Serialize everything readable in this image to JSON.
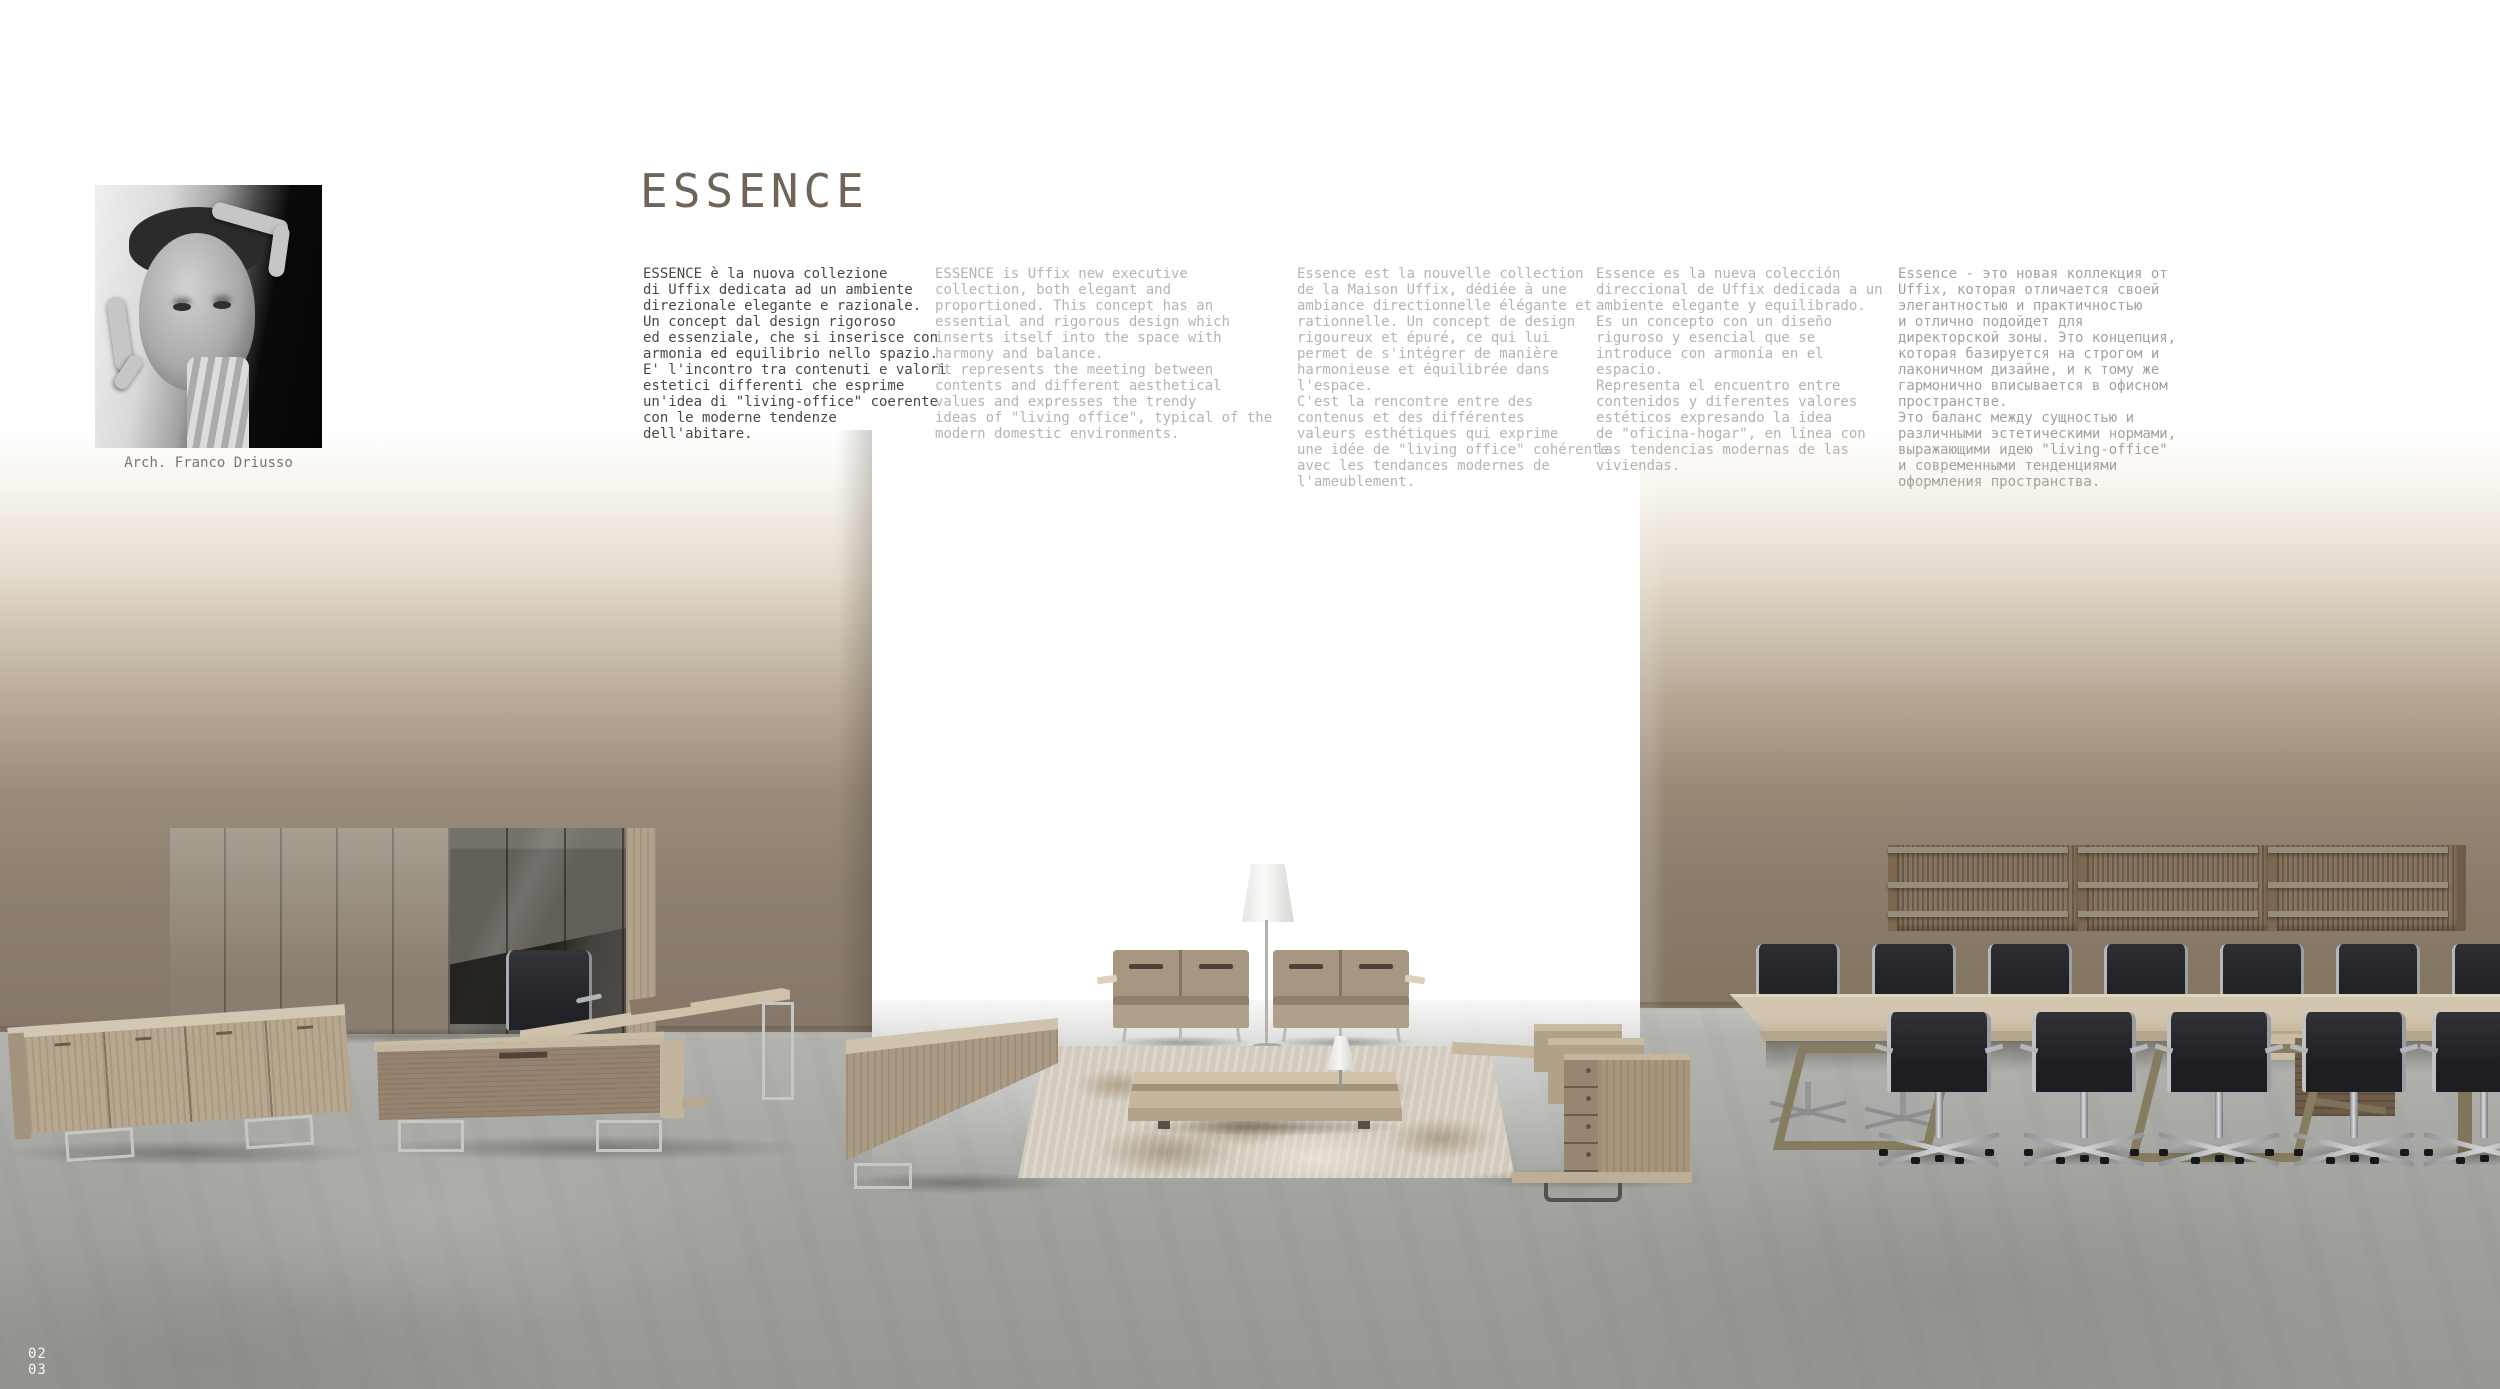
{
  "header": {
    "title": "ESSENCE"
  },
  "architect": {
    "caption": "Arch. Franco Driusso",
    "photo": "black-and-white-portrait-framing-gesture"
  },
  "columns": [
    {
      "lang": "it",
      "text": "ESSENCE è la nuova collezione\ndi Uffix dedicata ad un ambiente\ndirezionale elegante e razionale.\nUn concept dal design rigoroso\ned essenziale, che si inserisce con\narmonia ed equilibrio nello spazio.\nE' l'incontro tra contenuti e valori\nestetici differenti che esprime\nun'idea di \"living-office\" coerente\ncon le moderne tendenze\ndell'abitare."
    },
    {
      "lang": "en",
      "text": "ESSENCE is Uffix new executive\ncollection, both elegant and\nproportioned. This concept has an\nessential and rigorous design which\ninserts itself into the space with\nharmony and balance.\nIt represents the meeting between\ncontents and different aesthetical\nvalues and expresses the trendy\nideas of \"living office\", typical of the\nmodern domestic environments."
    },
    {
      "lang": "fr",
      "text": "Essence est la nouvelle collection\nde la Maison Uffix, dédiée à une\nambiance directionnelle élégante et\nrationnelle. Un concept de design\nrigoureux et épuré, ce qui lui\npermet de s'intégrer de manière\nharmonieuse et équilibrée dans\nl'espace.\nC'est la rencontre entre des\ncontenus et des différentes\nvaleurs esthétiques qui exprime\nune idée de \"living office\" cohérente\navec les tendances modernes de\nl'ameublement."
    },
    {
      "lang": "es",
      "text": "Essence es la nueva colección\ndireccional de Uffix dedicada a un\nambiente elegante y equilibrado.\nEs un concepto con un diseño\nriguroso y esencial que se\nintroduce con armonía en el\nespacio.\nRepresenta el encuentro entre\ncontenidos y diferentes valores\nestéticos expresando la idea\nde \"oficina-hogar\", en línea con\nlas tendencias modernas de las\nviviendas."
    },
    {
      "lang": "ru",
      "text": "Essence - это новая коллекция от\nUffix, которая отличается своей\nэлегантностью и практичностью\nи отлично подойдет для\nдиректорской зоны. Это концепция,\nкоторая базируется на строгом и\nлаконичном дизайне, и к тому же\nгармонично вписывается в офисном\nпространстве.\nЭто баланс между сущностью и\nразличными эстетическими нормами,\nвыражающими идею \"living-office\"\nи современными тенденциями\nоформления пространства."
    }
  ],
  "footer": {
    "page_top": "02",
    "page_bottom": "03"
  },
  "colors": {
    "title": "#6f6457",
    "text_primary": "#4c4840",
    "text_secondary": "#b7b4ae",
    "text_russian": "#a5a19a",
    "wall_taupe": "#8d8070",
    "floor_gray": "#a7a8a4",
    "oak_wood": "#b3a28a",
    "walnut_wood": "#8a7663",
    "chair_black": "#24262b",
    "chrome": "#c3c5c8"
  },
  "scene": {
    "items": [
      "tall-wall-cabinet",
      "executive-desk",
      "desk-office-chair",
      "sideboard",
      "low-bench",
      "two-seat-sofas",
      "floor-lamp",
      "area-rug",
      "low-coffee-table",
      "table-lamp",
      "drawer-bench",
      "wall-shelves",
      "conference-table",
      "conference-chairs"
    ]
  }
}
